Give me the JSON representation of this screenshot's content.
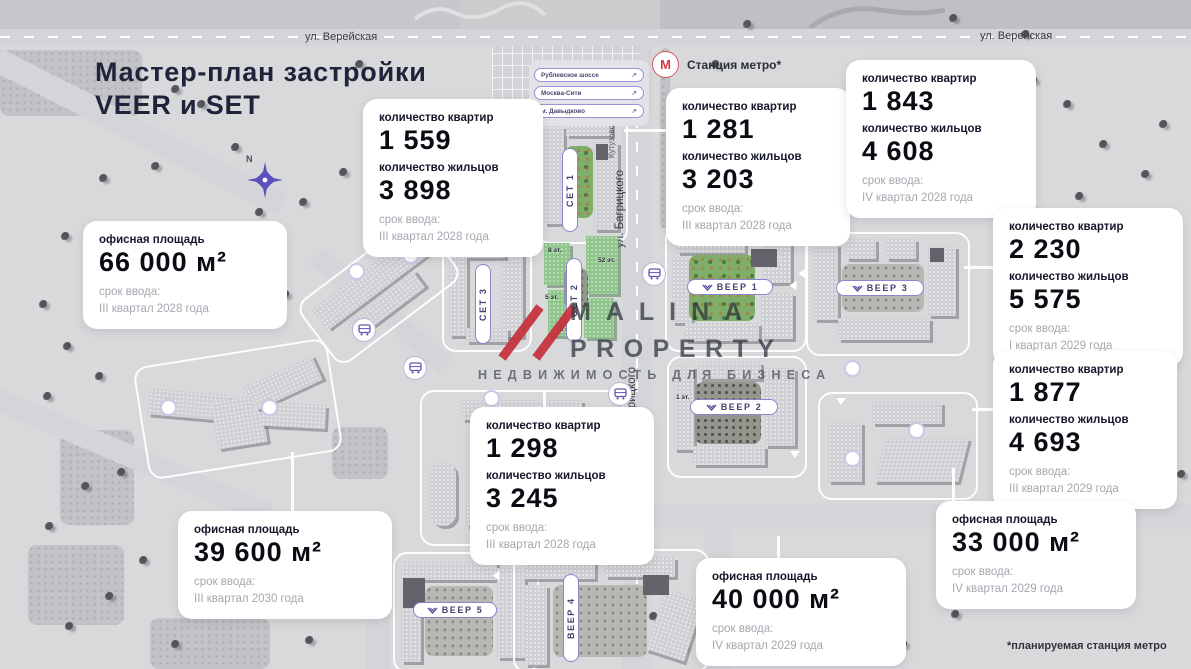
{
  "title": {
    "line1": "Мастер-план застройки",
    "line2": "VEER и SET"
  },
  "roads": {
    "vereyskaya_left": "ул. Верейская",
    "vereyskaya_right": "ул. Верейская",
    "bagritskogo_upper": "ул. Багрицкого",
    "bagritskogo_lower": "ул. Багрицкого",
    "kutuzovsky": "Кутузовский проспект"
  },
  "compass": {
    "north": "N"
  },
  "directions": {
    "items": [
      {
        "label": "Рублевское шоссе",
        "arrow": "↗"
      },
      {
        "label": "Москва-Сити",
        "arrow": "↗"
      },
      {
        "label": "м. Давыдково",
        "arrow": "↗"
      }
    ]
  },
  "metro": {
    "symbol": "М",
    "label": "Станция метро*"
  },
  "cards": [
    {
      "apartments_label": "количество квартир",
      "apartments": "1 559",
      "residents_label": "количество жильцов",
      "residents": "3 898",
      "term_label": "срок ввода:",
      "term": "III квартал 2028 года"
    },
    {
      "apartments_label": "количество квартир",
      "apartments": "1 281",
      "residents_label": "количество жильцов",
      "residents": "3 203",
      "term_label": "срок ввода:",
      "term": "III квартал 2028 года"
    },
    {
      "apartments_label": "количество квартир",
      "apartments": "1 843",
      "residents_label": "количество жильцов",
      "residents": "4 608",
      "term_label": "срок ввода:",
      "term": "IV квартал 2028 года"
    },
    {
      "apartments_label": "количество квартир",
      "apartments": "2 230",
      "residents_label": "количество жильцов",
      "residents": "5 575",
      "term_label": "срок ввода:",
      "term": "I квартал 2029 года"
    },
    {
      "apartments_label": "количество квартир",
      "apartments": "1 877",
      "residents_label": "количество жильцов",
      "residents": "4 693",
      "term_label": "срок ввода:",
      "term": "III квартал 2029 года"
    },
    {
      "apartments_label": "количество квартир",
      "apartments": "1 298",
      "residents_label": "количество жильцов",
      "residents": "3 245",
      "term_label": "срок ввода:",
      "term": "III квартал 2028 года"
    }
  ],
  "office_cards": [
    {
      "area_label": "офисная площадь",
      "area": "66 000 м²",
      "term_label": "срок ввода:",
      "term": "III квартал 2028 года"
    },
    {
      "area_label": "офисная площадь",
      "area": "39 600 м²",
      "term_label": "срок ввода:",
      "term": "III квартал 2030 года"
    },
    {
      "area_label": "офисная площадь",
      "area": "40 000 м²",
      "term_label": "срок ввода:",
      "term": "IV квартал 2029 года"
    },
    {
      "area_label": "офисная площадь",
      "area": "33 000 м²",
      "term_label": "срок ввода:",
      "term": "IV квартал 2029 года"
    }
  ],
  "buildings": {
    "set1": "СЕТ 1",
    "set2": "СЕТ 2",
    "set3": "СЕТ 3",
    "veer1": "ВЕЕР 1",
    "veer2": "ВЕЕР 2",
    "veer3": "ВЕЕР 3",
    "veer4": "ВЕЕР 4",
    "veer5": "ВЕЕР 5"
  },
  "floors": {
    "f8": "8 эт.",
    "f52": "52 эт.",
    "f5": "5 эт.",
    "f28": "28 эт.",
    "f1": "1 эт."
  },
  "watermark": {
    "brand_line1": "MALINA",
    "brand_line2": "PROPERTY",
    "tagline": "НЕДВИЖИМОСТЬ ДЛЯ БИЗНЕСА"
  },
  "footnote": "*планируемая станция метро",
  "colors": {
    "accent_purple": "#5f58b0",
    "metro_red": "#cf3a46",
    "watermark_red": "#c5303c",
    "card_bg": "#ffffff",
    "map_bg": "#d8d9db"
  }
}
